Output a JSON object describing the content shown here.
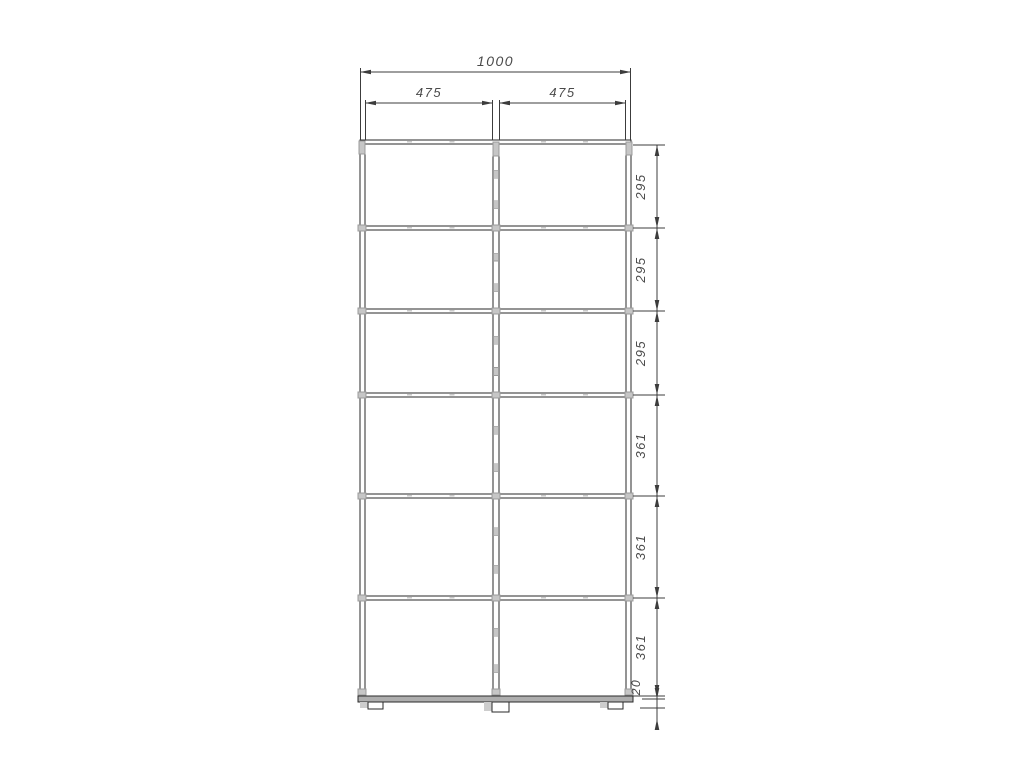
{
  "page": {
    "background": "#ffffff"
  },
  "drawing": {
    "kind": "furniture-assembly-front-view",
    "units": "mm",
    "labels": {
      "overall_width": "1000",
      "column_width_left": "475",
      "column_width_right": "475",
      "row_heights": [
        "295",
        "295",
        "295",
        "361",
        "361",
        "361"
      ],
      "plinth_height": "20"
    },
    "colors": {
      "line": "#2a2a2a",
      "dim": "#3c3c3c",
      "text": "#4a4a4a",
      "connector": "#c6c6c6",
      "connector_border": "#9b9b9b",
      "base_fill": "#aeaeae",
      "foot_shadow": "#cdcdcd",
      "tick": "#c9c9c9",
      "background": "#ffffff"
    },
    "layout": {
      "canvas": {
        "width": 1024,
        "height": 768
      },
      "cabinet": {
        "left_outer": 360,
        "left_inner": 365,
        "divider_left": 493,
        "divider_right": 499,
        "right_inner": 626,
        "right_outer": 631,
        "top": 140,
        "top_inner": 144,
        "row_bounds": [
          145,
          228,
          311,
          395,
          496,
          598,
          696
        ],
        "base_top": 696,
        "base_bottom": 702,
        "feet": [
          {
            "x": 368,
            "w": 15,
            "h": 7
          },
          {
            "x": 492,
            "w": 17,
            "h": 10
          },
          {
            "x": 608,
            "w": 15,
            "h": 7
          }
        ],
        "shelf_thickness": 4,
        "tick_fractions": [
          0.33,
          0.66
        ],
        "divider_connector_fractions": [
          0.35,
          0.72
        ]
      },
      "dims": {
        "overall": {
          "y": 72,
          "ext_top": 68,
          "text_y": 66
        },
        "columns": {
          "y": 103,
          "ext_top": 100,
          "text_y": 97
        },
        "rows": {
          "line_x": 657,
          "ext_x1": 633,
          "ext_x2": 665,
          "text_x": 645
        },
        "plinth": {
          "top_y": 699,
          "bottom_y": 708,
          "tail_y": 722,
          "text_x": 640,
          "text_y": 687
        }
      }
    }
  }
}
